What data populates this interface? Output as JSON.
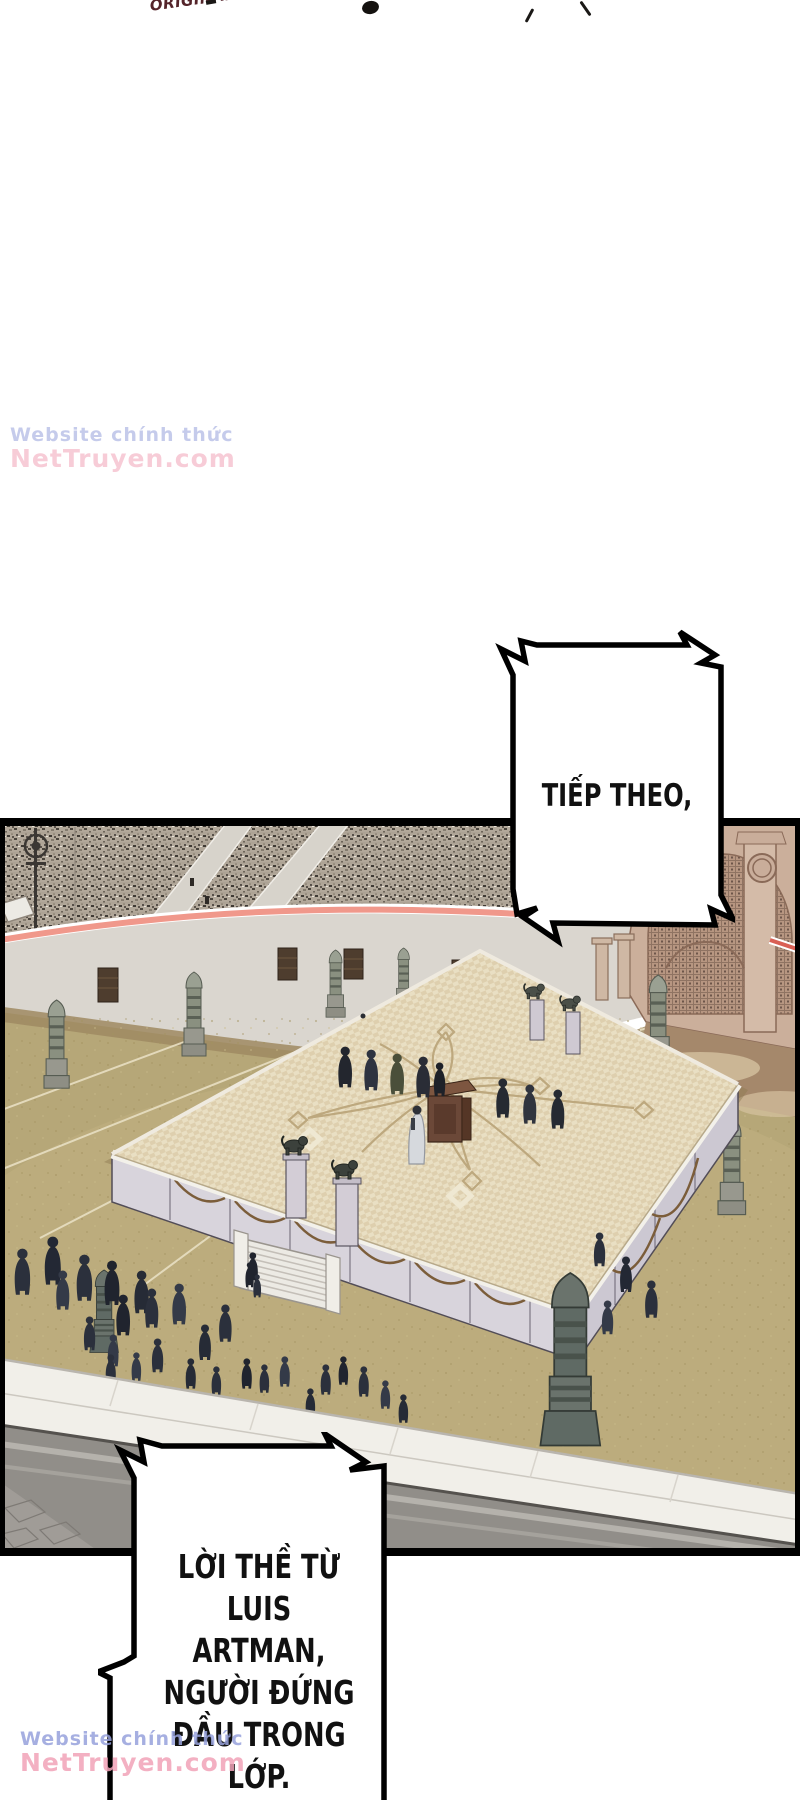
{
  "page_type": "webtoon-comic-page",
  "logo": {
    "prefix": "ORIGINAL",
    "title": "TRA BINH GAUD",
    "prefix_color": "#54242a",
    "title_color": "#161414"
  },
  "watermark": {
    "line1": "Website chính thức",
    "line2": "NetTruyen.com",
    "line1_color": "#97a2dc",
    "line2_color": "#f2a3b8"
  },
  "speech_bubbles": {
    "next": {
      "text": "TIẾP THEO,"
    },
    "oath": {
      "lines": [
        "LỜI THỀ TỪ",
        "LUIS ARTMAN,",
        "NGƯỜI ĐỨNG",
        "ĐẦU TRONG",
        "LỚP."
      ]
    }
  },
  "panel_scene": {
    "description": "aerial view of a colosseum arena: crowded stands, pink railing, gray wall with gates, olive sand floor with obelisk pillars, central checkered ceremonial platform with podium, officials and lion statues, cloaked crowd below, marble walkway and archway entrance",
    "colors": {
      "border": "#000000",
      "stands_base": "#b2a89a",
      "railing_pink": "#f0988b",
      "wall_gray": "#dad6cf",
      "floor_olive": "#b6a778",
      "platform_tile": "#e9dfc3",
      "platform_wall": "#d8d4dc",
      "garland_bronze": "#7b5d3a",
      "podium_brown": "#6b4838",
      "figure_dark": "#2b303c",
      "archway_tan": "#cbaf9b",
      "walkway_white": "#f1efe9",
      "lower_wall_gray": "#918e89"
    }
  }
}
